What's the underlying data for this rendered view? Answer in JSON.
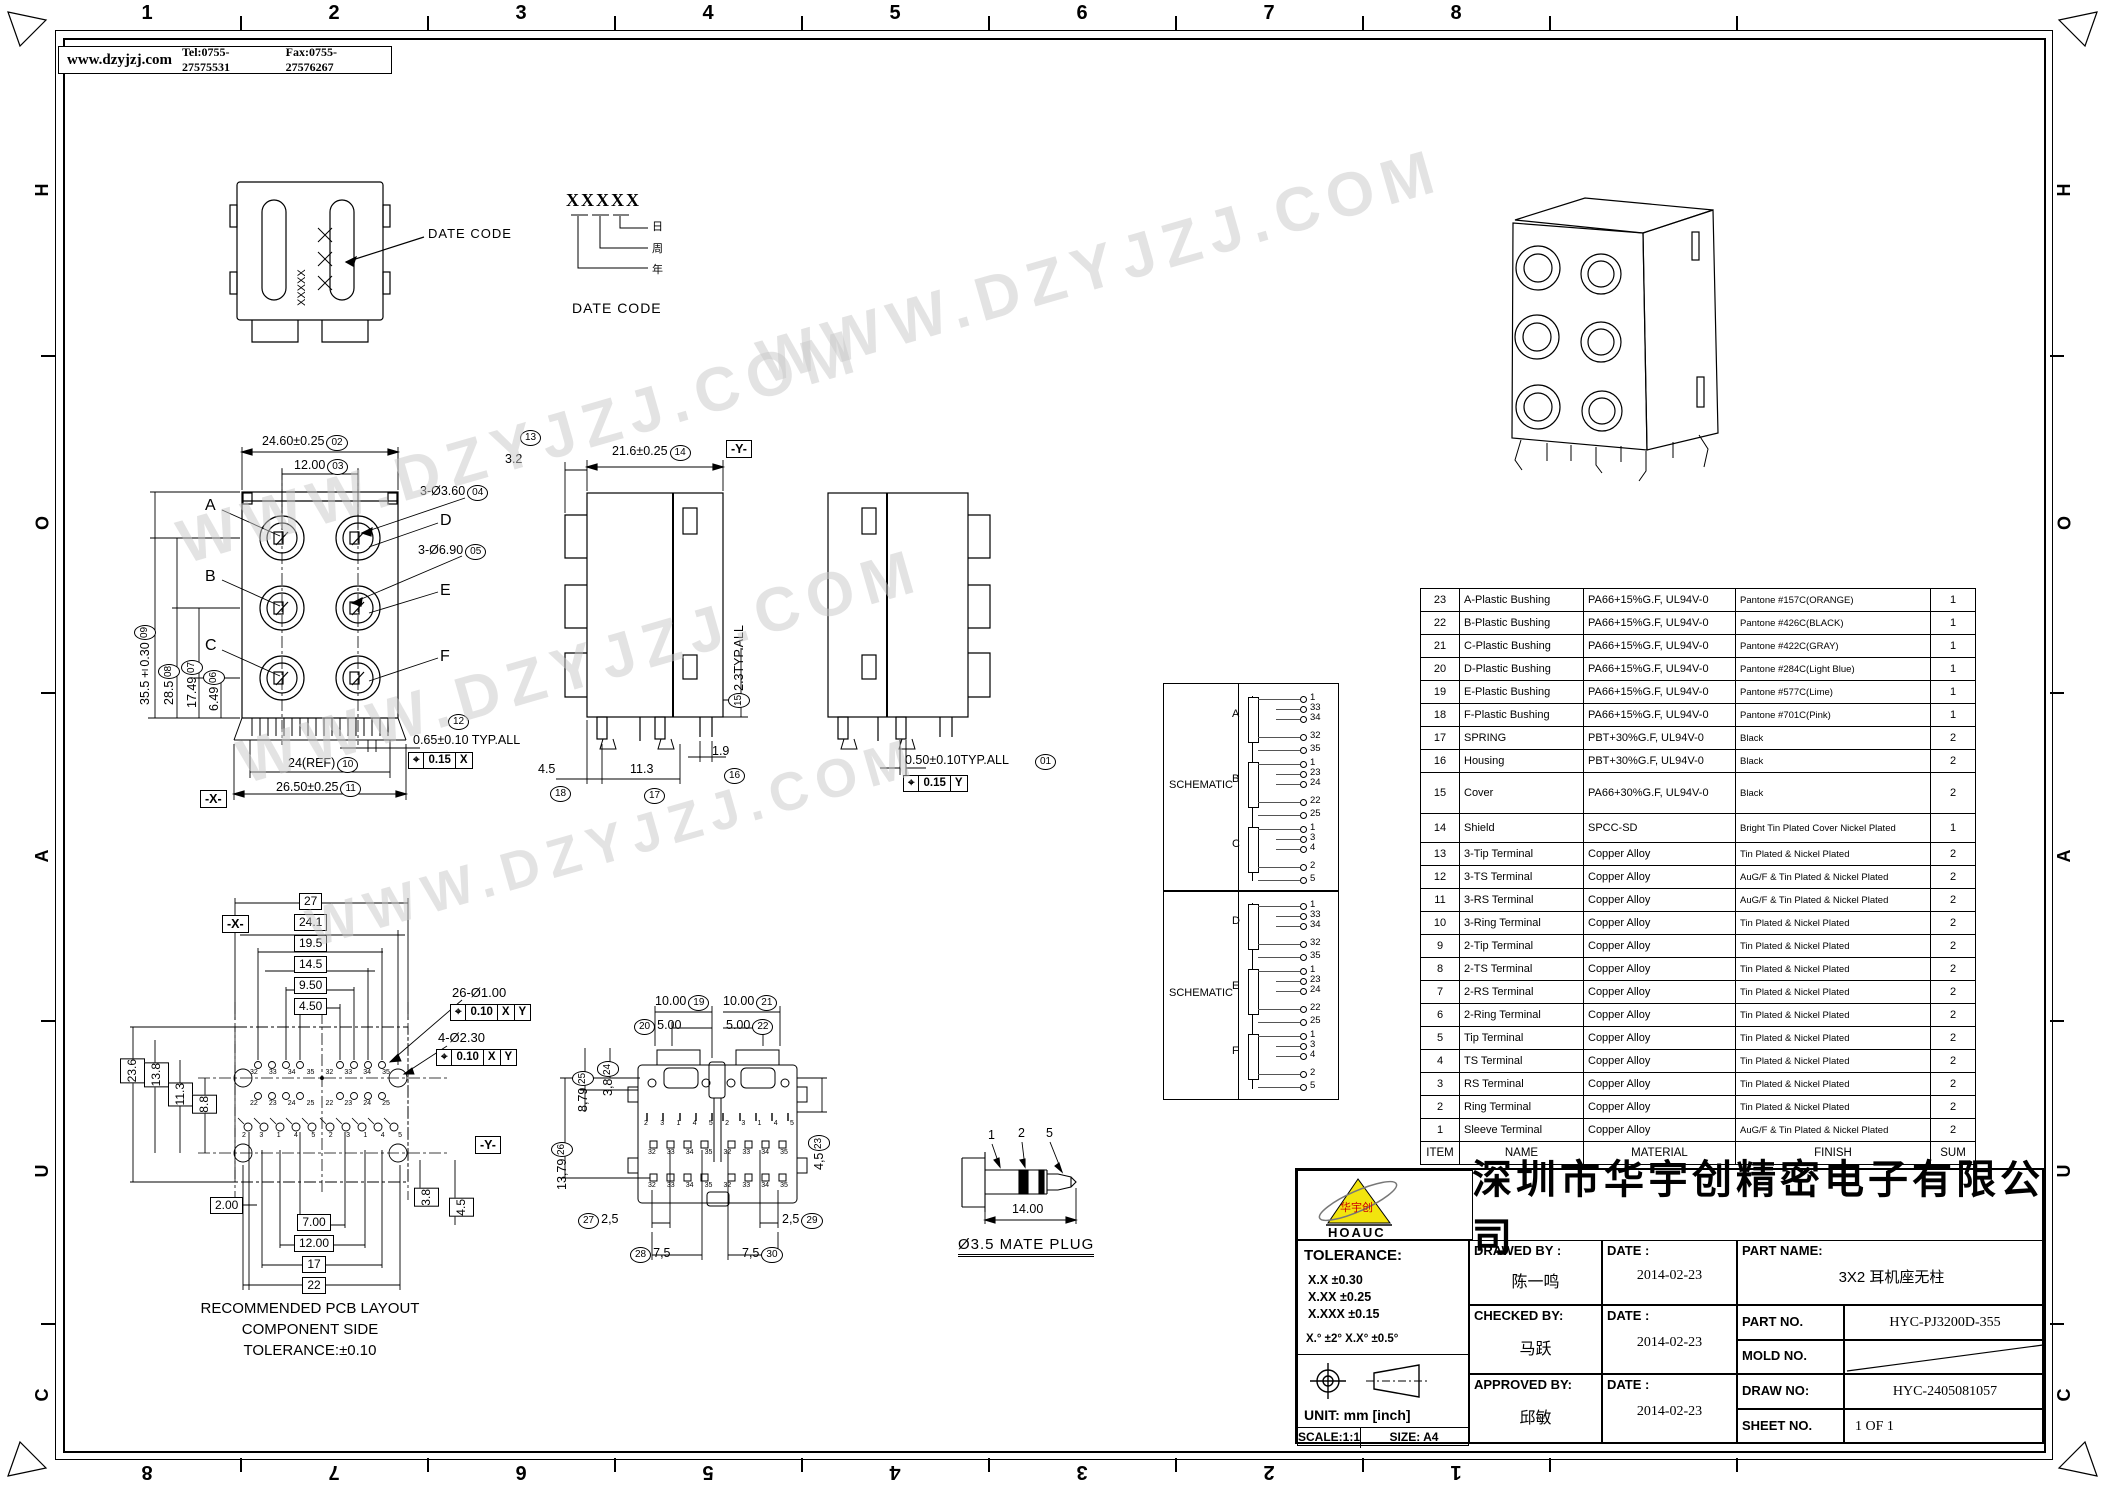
{
  "frame": {
    "zone_columns": [
      "1",
      "2",
      "3",
      "4",
      "5",
      "6",
      "7",
      "8"
    ],
    "zone_rows": [
      "H",
      "O",
      "A",
      "U",
      "C"
    ],
    "header": {
      "website": "www.dzyjzj.com",
      "tel": "Tel:0755-27575531",
      "fax": "Fax:0755-27576267"
    },
    "watermark_text": "WWW.DZYJZJ.COM"
  },
  "datecode_view": {
    "marking": "XXXXX",
    "callout": "DATE CODE",
    "legend_code": "XXXXX",
    "legend_day": "日",
    "legend_week": "周",
    "legend_year": "年",
    "legend_caption": "DATE CODE"
  },
  "front_view": {
    "port_labels": [
      "A",
      "B",
      "C",
      "D",
      "E",
      "F"
    ],
    "dims": {
      "width_top": {
        "text": "24.60±0.25",
        "balloon": "02"
      },
      "pitch": {
        "text": "12.00",
        "balloon": "03"
      },
      "hole_small": {
        "text": "3-Ø3.60",
        "balloon": "04"
      },
      "hole_big": {
        "text": "3-Ø6.90",
        "balloon": "05"
      },
      "h1": {
        "text": "6.49",
        "balloon": "06"
      },
      "h2": {
        "text": "17.49",
        "balloon": "07"
      },
      "h3": {
        "text": "28.5",
        "balloon": "08"
      },
      "height": {
        "text": "35.5±0.30",
        "balloon": "09"
      },
      "width_ref": {
        "text": "24(REF)",
        "balloon": "10"
      },
      "width_bottom": {
        "text": "26.50±0.25",
        "balloon": "11"
      },
      "pin_pitch": {
        "text": "0.65±0.10  TYP.ALL",
        "balloon": "12"
      }
    },
    "gdt": {
      "symbol": "⌖",
      "tol": "0.15",
      "datum": "X"
    },
    "datum_flag": "-X-"
  },
  "side_view": {
    "dims": {
      "d13": {
        "text": "3.2",
        "balloon": "13"
      },
      "d14": {
        "text": "21.6±0.25",
        "balloon": "14"
      },
      "d15": {
        "text": "2.3TYP.ALL",
        "balloon": "15"
      },
      "d16": {
        "text": "1.9",
        "balloon": "16"
      },
      "d17": {
        "text": "11.3",
        "balloon": "17"
      },
      "d18": {
        "text": "4.5",
        "balloon": "18"
      }
    },
    "datum_flag": "-Y-"
  },
  "rear_side_view": {
    "dims": {
      "d01": {
        "text": "0.50±0.10TYP.ALL",
        "balloon": "01"
      }
    },
    "gdt": {
      "symbol": "⌖",
      "tol": "0.15",
      "datum": "Y"
    }
  },
  "pcb_view": {
    "dims_top": [
      "27",
      "24.1",
      "19.5",
      "14.5",
      "9.50",
      "4.50"
    ],
    "dims_left": [
      "23.6",
      "13.8",
      "11.3",
      "8.8"
    ],
    "dim_bottom_left": "2.00",
    "dims_bottom": [
      "7.00",
      "12.00",
      "17",
      "22"
    ],
    "dims_right": [
      "3.8",
      "4.5"
    ],
    "hole_note_1": {
      "text": "26-Ø1.00",
      "gdt": {
        "symbol": "⌖",
        "tol": "0.10",
        "datum1": "X",
        "datum2": "Y"
      }
    },
    "hole_note_2": {
      "text": "4-Ø2.30",
      "gdt": {
        "symbol": "⌖",
        "tol": "0.10",
        "datum1": "X",
        "datum2": "Y"
      }
    },
    "datum_x": "-X-",
    "datum_y": "-Y-",
    "pad_rows": [
      [
        "32",
        "33",
        "34",
        "35",
        "32",
        "33",
        "34",
        "35"
      ],
      [
        "22",
        "23",
        "24",
        "25",
        "22",
        "23",
        "24",
        "25"
      ],
      [
        "2",
        "3",
        "1",
        "4",
        "5",
        "2",
        "3",
        "1",
        "4",
        "5"
      ]
    ],
    "caption": [
      "RECOMMENDED PCB LAYOUT",
      "COMPONENT SIDE",
      "TOLERANCE:±0.10"
    ]
  },
  "bottom_view": {
    "dims": {
      "d19": {
        "text": "10.00",
        "balloon": "19"
      },
      "d20": {
        "text": "5.00",
        "balloon": "20"
      },
      "d21": {
        "text": "10.00",
        "balloon": "21"
      },
      "d22": {
        "text": "5.00",
        "balloon": "22"
      },
      "d23": {
        "text": "4,5",
        "balloon": "23"
      },
      "d24": {
        "text": "3,8",
        "balloon": "24"
      },
      "d25": {
        "text": "8,79",
        "balloon": "25"
      },
      "d26": {
        "text": "13,79",
        "balloon": "26"
      },
      "d27": {
        "text": "2,5",
        "balloon": "27"
      },
      "d28": {
        "text": "7,5",
        "balloon": "28"
      },
      "d29": {
        "text": "2,5",
        "balloon": "29"
      },
      "d30": {
        "text": "7,5",
        "balloon": "30"
      }
    },
    "pin_rows": [
      [
        "2",
        "3",
        "1",
        "4",
        "5",
        "2",
        "3",
        "1",
        "4",
        "5"
      ],
      [
        "32",
        "33",
        "34",
        "35",
        "32",
        "33",
        "34",
        "35"
      ],
      [
        "32",
        "33",
        "34",
        "35",
        "32",
        "33",
        "34",
        "35"
      ]
    ]
  },
  "plug_view": {
    "labels": [
      "1",
      "2",
      "5"
    ],
    "dim": "14.00",
    "caption": "Ø3.5  MATE  PLUG"
  },
  "schematics": [
    {
      "label": "SCHEMATIC",
      "sections": [
        {
          "name": "A",
          "pins": [
            "1",
            "33",
            "34",
            "32",
            "35"
          ]
        },
        {
          "name": "B",
          "pins": [
            "1",
            "23",
            "24",
            "22",
            "25"
          ]
        },
        {
          "name": "C",
          "pins": [
            "1",
            "3",
            "4",
            "2",
            "5"
          ]
        }
      ]
    },
    {
      "label": "SCHEMATIC",
      "sections": [
        {
          "name": "D",
          "pins": [
            "1",
            "33",
            "34",
            "32",
            "35"
          ]
        },
        {
          "name": "E",
          "pins": [
            "1",
            "23",
            "24",
            "22",
            "25"
          ]
        },
        {
          "name": "F",
          "pins": [
            "1",
            "3",
            "4",
            "2",
            "5"
          ]
        }
      ]
    }
  ],
  "parts_table": {
    "headers": [
      "ITEM",
      "NAME",
      "MATERIAL",
      "FINISH",
      "SUM"
    ],
    "rows": [
      [
        "23",
        "A-Plastic Bushing",
        "PA66+15%G.F, UL94V-0",
        "Pantone #157C(ORANGE)",
        "1"
      ],
      [
        "22",
        "B-Plastic Bushing",
        "PA66+15%G.F, UL94V-0",
        "Pantone #426C(BLACK)",
        "1"
      ],
      [
        "21",
        "C-Plastic Bushing",
        "PA66+15%G.F, UL94V-0",
        "Pantone #422C(GRAY)",
        "1"
      ],
      [
        "20",
        "D-Plastic Bushing",
        "PA66+15%G.F, UL94V-0",
        "Pantone #284C(Light Blue)",
        "1"
      ],
      [
        "19",
        "E-Plastic Bushing",
        "PA66+15%G.F, UL94V-0",
        "Pantone #577C(Lime)",
        "1"
      ],
      [
        "18",
        "F-Plastic Bushing",
        "PA66+15%G.F, UL94V-0",
        "Pantone #701C(Pink)",
        "1"
      ],
      [
        "17",
        "SPRING",
        "PBT+30%G.F, UL94V-0",
        "Black",
        "2"
      ],
      [
        "16",
        "Housing",
        "PBT+30%G.F, UL94V-0",
        "Black",
        "2"
      ],
      [
        "15",
        "Cover",
        "PA66+30%G.F, UL94V-0",
        "Black",
        "2"
      ],
      [
        "14",
        "Shield",
        "SPCC-SD",
        "Bright Tin Plated Cover Nickel Plated",
        "1"
      ],
      [
        "13",
        "3-Tip Terminal",
        "Copper Alloy",
        "Tin Plated & Nickel Plated",
        "2"
      ],
      [
        "12",
        "3-TS Terminal",
        "Copper Alloy",
        "AuG/F & Tin Plated & Nickel Plated",
        "2"
      ],
      [
        "11",
        "3-RS Terminal",
        "Copper Alloy",
        "AuG/F & Tin Plated & Nickel Plated",
        "2"
      ],
      [
        "10",
        "3-Ring Terminal",
        "Copper Alloy",
        "Tin Plated & Nickel Plated",
        "2"
      ],
      [
        "9",
        "2-Tip Terminal",
        "Copper Alloy",
        "Tin Plated & Nickel Plated",
        "2"
      ],
      [
        "8",
        "2-TS Terminal",
        "Copper Alloy",
        "Tin Plated & Nickel Plated",
        "2"
      ],
      [
        "7",
        "2-RS Terminal",
        "Copper Alloy",
        "Tin Plated & Nickel Plated",
        "2"
      ],
      [
        "6",
        "2-Ring Terminal",
        "Copper Alloy",
        "Tin Plated & Nickel Plated",
        "2"
      ],
      [
        "5",
        "Tip Terminal",
        "Copper Alloy",
        "Tin Plated & Nickel Plated",
        "2"
      ],
      [
        "4",
        "TS Terminal",
        "Copper Alloy",
        "Tin Plated & Nickel Plated",
        "2"
      ],
      [
        "3",
        "RS Terminal",
        "Copper Alloy",
        "Tin Plated & Nickel Plated",
        "2"
      ],
      [
        "2",
        "Ring Terminal",
        "Copper Alloy",
        "Tin Plated & Nickel Plated",
        "2"
      ],
      [
        "1",
        "Sleeve Terminal",
        "Copper Alloy",
        "AuG/F & Tin Plated & Nickel Plated",
        "2"
      ]
    ]
  },
  "title_block": {
    "logo": {
      "text": "HOAUC",
      "mark": "华宇创"
    },
    "company": "深圳市华宇创精密电子有限公司",
    "tolerance": {
      "title": "TOLERANCE:",
      "line1": "X.X    ±0.30",
      "line2": "X.XX   ±0.25",
      "line3": "X.XXX  ±0.15",
      "angles": "X.°  ±2°        X.X°  ±0.5°"
    },
    "unit": "UNIT:  mm  [inch]",
    "scale": "SCALE:1:1",
    "size": "SIZE:  A4",
    "drawed": {
      "label": "DRAWED  BY  :",
      "name": "陈一鸣",
      "date_label": "DATE  :",
      "date": "2014-02-23"
    },
    "checked": {
      "label": "CHECKED  BY:",
      "name": "马跃",
      "date_label": "DATE  :",
      "date": "2014-02-23"
    },
    "approved": {
      "label": "APPROVED  BY:",
      "name": "邱敏",
      "date_label": "DATE  :",
      "date": "2014-02-23"
    },
    "part_name": {
      "label": "PART  NAME:",
      "value": "3X2 耳机座无柱"
    },
    "part_no": {
      "label": "PART  NO.",
      "value": "HYC-PJ3200D-355"
    },
    "mold_no": {
      "label": "MOLD  NO.",
      "value": ""
    },
    "draw_no": {
      "label": "DRAW  NO:",
      "value": "HYC-2405081057"
    },
    "sheet_no": {
      "label": "SHEET  NO.",
      "value": "1 OF 1"
    }
  }
}
